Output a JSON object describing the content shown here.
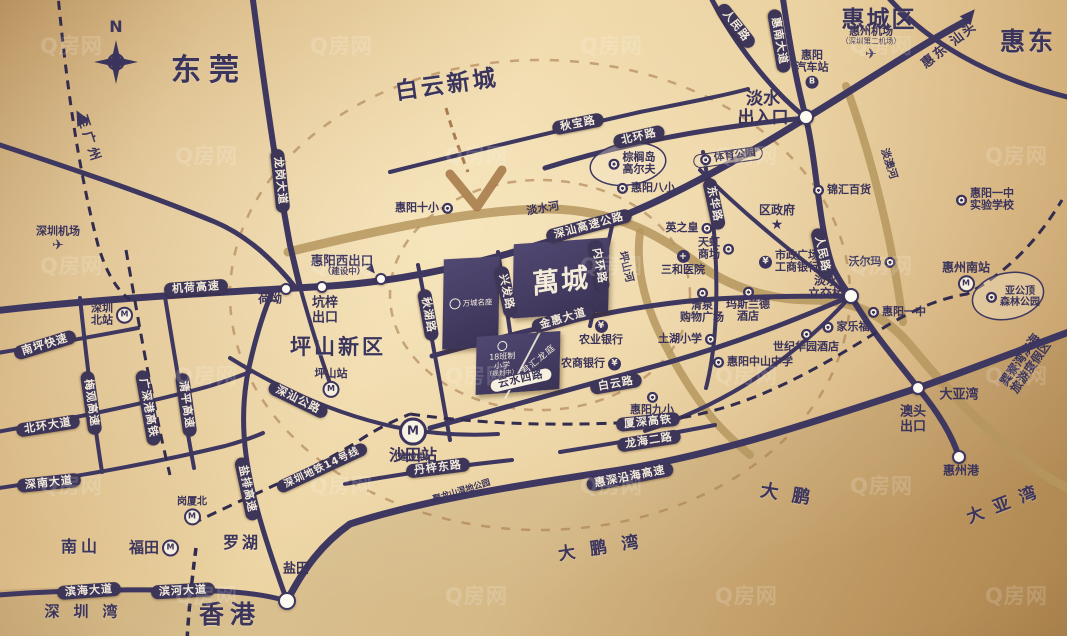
{
  "map": {
    "title": "萬城区位图",
    "watermark": {
      "text": "Q房网"
    },
    "colors": {
      "ink": "#3b345c",
      "road": "#3e3760",
      "river": "#b5965e",
      "gold_bg": "#e7cc99",
      "accent_tan": "#a87c4c"
    },
    "project": {
      "name": "萬城"
    },
    "blocks": {
      "mingzuo": "万城名座",
      "school_line1": "18班制",
      "school_line2": "小学",
      "school_line3": "（规划中）",
      "junhui": "君汇龙庭"
    },
    "junctions": [
      {
        "x": 806,
        "y": 117,
        "r": 6
      },
      {
        "x": 851,
        "y": 296,
        "r": 6
      },
      {
        "x": 287,
        "y": 601,
        "r": 7
      },
      {
        "x": 918,
        "y": 388,
        "r": 5
      },
      {
        "x": 286,
        "y": 289,
        "r": 4
      },
      {
        "x": 322,
        "y": 287,
        "r": 4
      },
      {
        "x": 381,
        "y": 279,
        "r": 4
      },
      {
        "x": 959,
        "y": 457,
        "r": 5
      }
    ],
    "labels": [
      {
        "name": "compass-n-label",
        "kind": "text",
        "text": "N",
        "x": 116,
        "y": 27,
        "size": 16,
        "cls": "bold"
      },
      {
        "name": "label-dongguan",
        "kind": "area",
        "text": "东莞",
        "x": 209,
        "y": 71,
        "size": 30,
        "ls": 8
      },
      {
        "name": "label-baiyun-xincheng",
        "kind": "area",
        "text": "白云新城",
        "x": 447,
        "y": 86,
        "size": 23,
        "rot": -8,
        "ls": 3
      },
      {
        "name": "label-huicheng-district",
        "kind": "area",
        "text": "惠城区",
        "x": 879,
        "y": 21,
        "size": 23,
        "ls": 2
      },
      {
        "name": "label-huidong",
        "kind": "area",
        "text": "惠东",
        "x": 1028,
        "y": 42,
        "size": 25,
        "ls": 3
      },
      {
        "name": "label-huidong-shantou",
        "kind": "text",
        "text": "惠东 汕头",
        "x": 950,
        "y": 46,
        "size": 13,
        "rot": -38,
        "ls": 2
      },
      {
        "name": "label-to-guangzhou",
        "kind": "text",
        "text": "至广州",
        "x": 88,
        "y": 140,
        "size": 13,
        "rot": 72,
        "ls": 4
      },
      {
        "name": "label-pingshan-new-district",
        "kind": "area",
        "text": "坪山新区",
        "x": 338,
        "y": 348,
        "size": 21,
        "ls": 3
      },
      {
        "name": "label-nanshan",
        "kind": "area",
        "text": "南山",
        "x": 81,
        "y": 547,
        "size": 16,
        "ls": 4
      },
      {
        "name": "label-luohu",
        "kind": "area",
        "text": "罗湖",
        "x": 242,
        "y": 543,
        "size": 16,
        "ls": 3
      },
      {
        "name": "label-yantian",
        "kind": "text",
        "text": "盐田",
        "x": 296,
        "y": 570,
        "size": 13
      },
      {
        "name": "label-hongkong",
        "kind": "area",
        "text": "香港",
        "x": 230,
        "y": 615,
        "size": 25,
        "ls": 6
      },
      {
        "name": "label-shenzhen-bay",
        "kind": "area",
        "text": "深圳湾",
        "x": 88,
        "y": 612,
        "size": 15,
        "ls": 14
      },
      {
        "name": "label-dapeng",
        "kind": "area",
        "text": "大鹏",
        "x": 792,
        "y": 496,
        "size": 18,
        "ls": 14,
        "rot": 9
      },
      {
        "name": "label-dapeng-bay",
        "kind": "area",
        "text": "大鹏湾",
        "x": 606,
        "y": 548,
        "size": 17,
        "ls": 15,
        "rot": -9
      },
      {
        "name": "label-daya-bay-big",
        "kind": "area",
        "text": "大亚湾",
        "x": 1007,
        "y": 504,
        "size": 17,
        "ls": 11,
        "rot": -21
      },
      {
        "name": "road-longgang-avenue",
        "kind": "capsule",
        "text": "龙岗大道",
        "x": 280,
        "y": 181,
        "rot": 84
      },
      {
        "name": "road-jihe-expressway",
        "kind": "capsule",
        "text": "机荷高速",
        "x": 196,
        "y": 288,
        "rot": -4
      },
      {
        "name": "road-qiubao-road",
        "kind": "capsule",
        "text": "秋宝路",
        "x": 578,
        "y": 124,
        "rot": -11
      },
      {
        "name": "road-beihuan-road",
        "kind": "capsule",
        "text": "北环路",
        "x": 639,
        "y": 137,
        "rot": -13
      },
      {
        "name": "road-huinan-avenue",
        "kind": "capsule",
        "text": "惠南大道",
        "x": 779,
        "y": 41,
        "rot": 80
      },
      {
        "name": "road-renmin-road-north",
        "kind": "capsule",
        "text": "人民路",
        "x": 736,
        "y": 26,
        "rot": 52
      },
      {
        "name": "road-renmin-road",
        "kind": "capsule",
        "text": "人民路",
        "x": 822,
        "y": 254,
        "rot": 78
      },
      {
        "name": "road-donghua-road",
        "kind": "capsule",
        "text": "东华路",
        "x": 714,
        "y": 204,
        "rot": 78
      },
      {
        "name": "road-shenshan-expressway",
        "kind": "capsule",
        "text": "深汕高速公路",
        "x": 589,
        "y": 226,
        "rot": -15
      },
      {
        "name": "road-neihuan-road",
        "kind": "capsule",
        "text": "内环路",
        "x": 599,
        "y": 266,
        "rot": 80
      },
      {
        "name": "road-xingfa-road",
        "kind": "capsule",
        "text": "兴发路",
        "x": 506,
        "y": 292,
        "rot": 78
      },
      {
        "name": "road-qiuhu-road",
        "kind": "capsule",
        "text": "秋湖路",
        "x": 428,
        "y": 315,
        "rot": 80
      },
      {
        "name": "road-jinhui-avenue",
        "kind": "capsule",
        "text": "金惠大道",
        "x": 563,
        "y": 319,
        "rot": -16
      },
      {
        "name": "road-baiyun-road",
        "kind": "capsule",
        "text": "白云路",
        "x": 616,
        "y": 384,
        "rot": -10
      },
      {
        "name": "road-shenshan-highway",
        "kind": "capsule",
        "text": "深汕公路",
        "x": 298,
        "y": 400,
        "rot": 26
      },
      {
        "name": "road-nanping-expressway",
        "kind": "capsule",
        "text": "南坪快速",
        "x": 45,
        "y": 345,
        "rot": -17
      },
      {
        "name": "road-meiguan-expressway",
        "kind": "capsule",
        "text": "梅观高速",
        "x": 91,
        "y": 403,
        "rot": 82
      },
      {
        "name": "rail-guangshengang-hsr",
        "kind": "capsule",
        "text": "广深港高铁",
        "x": 148,
        "y": 408,
        "rot": 80
      },
      {
        "name": "road-qingping-expressway",
        "kind": "capsule",
        "text": "清平高速",
        "x": 186,
        "y": 405,
        "rot": 82
      },
      {
        "name": "road-beihuan-avenue",
        "kind": "capsule",
        "text": "北环大道",
        "x": 48,
        "y": 426,
        "rot": -9
      },
      {
        "name": "road-shennan-avenue",
        "kind": "capsule",
        "text": "深南大道",
        "x": 49,
        "y": 483,
        "rot": -6
      },
      {
        "name": "road-yanpai-expressway",
        "kind": "capsule",
        "text": "盐排高速",
        "x": 247,
        "y": 489,
        "rot": 78
      },
      {
        "name": "rail-shenzhen-metro-line14",
        "kind": "capsule",
        "text": "深圳地铁14号线",
        "x": 322,
        "y": 468,
        "rot": -25,
        "size": 10
      },
      {
        "name": "road-binhai-avenue",
        "kind": "capsule",
        "text": "滨海大道",
        "x": 89,
        "y": 591,
        "rot": -4
      },
      {
        "name": "road-binhe-avenue",
        "kind": "capsule",
        "text": "滨河大道",
        "x": 183,
        "y": 591,
        "rot": -3
      },
      {
        "name": "road-danzi-east-road",
        "kind": "capsule",
        "text": "丹梓东路",
        "x": 438,
        "y": 468,
        "rot": -7
      },
      {
        "name": "rail-xiashen-hsr",
        "kind": "capsule",
        "text": "厦深高铁",
        "x": 648,
        "y": 422,
        "rot": -6
      },
      {
        "name": "road-longhai-2nd-road",
        "kind": "capsule",
        "text": "龙海二路",
        "x": 649,
        "y": 441,
        "rot": -9
      },
      {
        "name": "road-huishen-coastal-expressway",
        "kind": "capsule",
        "text": "惠深沿海高速",
        "x": 630,
        "y": 477,
        "rot": -11
      },
      {
        "name": "road-yunshui-4th-road",
        "kind": "white-capsule",
        "text": "云水四路",
        "x": 521,
        "y": 380,
        "rot": -13
      },
      {
        "name": "poi-sports-park",
        "kind": "capsule-outline",
        "text": "体育公园",
        "x": 728,
        "y": 157,
        "rot": -8,
        "icon": "dot",
        "iconSide": "left"
      },
      {
        "name": "poi-shenzhen-airport",
        "kind": "poi",
        "text": "深圳机场",
        "x": 58,
        "y": 240,
        "icon": "air",
        "iconSide": "bottom"
      },
      {
        "name": "poi-shenzhen-north-station",
        "kind": "poi",
        "lines": [
          "深圳",
          "北站"
        ],
        "x": 112,
        "y": 315,
        "icon": "metro",
        "iconSide": "right"
      },
      {
        "name": "poi-pingshan-station",
        "kind": "poi",
        "text": "坪山站",
        "x": 331,
        "y": 383,
        "icon": "metro",
        "iconSide": "bottom"
      },
      {
        "name": "poi-shatian-station",
        "kind": "poi",
        "text": "沙田站",
        "x": 413,
        "y": 441,
        "size": 16,
        "icon": "metro-big",
        "iconSide": "top"
      },
      {
        "name": "label-shatian-under-construction",
        "kind": "text",
        "text": "（建设中）",
        "x": 412,
        "y": 458,
        "size": 9
      },
      {
        "name": "poi-gangxiabei-station",
        "kind": "poi",
        "text": "岗厦北",
        "x": 192,
        "y": 511,
        "size": 10,
        "icon": "metro",
        "iconSide": "bottom"
      },
      {
        "name": "poi-futian",
        "kind": "poi",
        "text": "福田",
        "x": 154,
        "y": 548,
        "size": 15,
        "icon": "metro",
        "iconSide": "right"
      },
      {
        "name": "poi-huiyang-no10-primary",
        "kind": "poi",
        "text": "惠阳十小",
        "x": 424,
        "y": 208,
        "icon": "dot",
        "iconSide": "right"
      },
      {
        "name": "poi-huiyang-no8-primary",
        "kind": "poi",
        "text": "惠阳八小",
        "x": 646,
        "y": 188,
        "icon": "dot",
        "iconSide": "left"
      },
      {
        "name": "poi-palm-island-golf",
        "kind": "poi",
        "lines": [
          "棕榈岛",
          "高尔夫"
        ],
        "x": 632,
        "y": 164,
        "icon": "dot",
        "iconSide": "left"
      },
      {
        "name": "poi-huiyang-bus-station",
        "kind": "poi",
        "lines": [
          "惠阳",
          "汽车站"
        ],
        "x": 812,
        "y": 69,
        "icon": "bus",
        "iconSide": "bottom"
      },
      {
        "name": "poi-huizhou-airport",
        "kind": "poi",
        "lines": [
          "惠州机场",
          "（深圳第二机场）"
        ],
        "subLast": true,
        "x": 871,
        "y": 44,
        "icon": "air",
        "iconSide": "bottom"
      },
      {
        "name": "poi-jinhui-department-store",
        "kind": "poi",
        "text": "锦汇百货",
        "x": 842,
        "y": 190,
        "icon": "cart",
        "iconSide": "left"
      },
      {
        "name": "poi-district-government",
        "kind": "poi",
        "text": "区政府",
        "x": 777,
        "y": 219,
        "size": 12,
        "icon": "star",
        "iconSide": "bottom"
      },
      {
        "name": "poi-yingzhihuang",
        "kind": "poi",
        "text": "英之皇",
        "x": 689,
        "y": 228,
        "icon": "dot",
        "iconSide": "right"
      },
      {
        "name": "poi-tianhong-mall",
        "kind": "poi",
        "lines": [
          "天虹",
          "商场"
        ],
        "x": 716,
        "y": 249,
        "icon": "dot",
        "iconSide": "right"
      },
      {
        "name": "poi-sanhe-hospital",
        "kind": "poi",
        "text": "三和医院",
        "x": 683,
        "y": 263,
        "icon": "hosp",
        "iconSide": "top"
      },
      {
        "name": "poi-municipal-plaza-icbc",
        "kind": "poi",
        "lines": [
          "市政广场",
          "工商银行"
        ],
        "x": 789,
        "y": 262,
        "icon": "bank",
        "iconSide": "left"
      },
      {
        "name": "poi-walmart",
        "kind": "poi",
        "text": "沃尔玛",
        "x": 872,
        "y": 262,
        "icon": "cart",
        "iconSide": "right"
      },
      {
        "name": "label-danshui-interchange",
        "kind": "text",
        "lines": [
          "淡水",
          "立交桥"
        ],
        "x": 826,
        "y": 288,
        "size": 12
      },
      {
        "name": "poi-huizhou-south-station",
        "kind": "poi",
        "text": "惠州南站",
        "x": 966,
        "y": 277,
        "size": 12,
        "icon": "metro",
        "iconSide": "bottom"
      },
      {
        "name": "poi-yagongding-forest-park",
        "kind": "poi",
        "lines": [
          "亚公顶",
          "森林公园"
        ],
        "x": 1013,
        "y": 297,
        "size": 10,
        "icon": "dot",
        "iconSide": "left"
      },
      {
        "name": "poi-huiyang-no1-experimental-school",
        "kind": "poi",
        "lines": [
          "惠阳一中",
          "实验学校"
        ],
        "x": 985,
        "y": 200,
        "icon": "dot",
        "iconSide": "left"
      },
      {
        "name": "poi-qingquan-shopping-plaza",
        "kind": "poi",
        "lines": [
          "清泉",
          "购物广场"
        ],
        "x": 702,
        "y": 306,
        "icon": "dot",
        "iconSide": "top"
      },
      {
        "name": "poi-maslande-hotel",
        "kind": "poi",
        "lines": [
          "玛斯兰德",
          "酒店"
        ],
        "x": 748,
        "y": 305,
        "icon": "dot",
        "iconSide": "top"
      },
      {
        "name": "poi-tuhu-primary-school",
        "kind": "poi",
        "text": "土湖小学",
        "x": 687,
        "y": 339,
        "icon": "dot",
        "iconSide": "right"
      },
      {
        "name": "poi-agricultural-bank",
        "kind": "poi",
        "text": "农业银行",
        "x": 601,
        "y": 333,
        "icon": "bank",
        "iconSide": "top"
      },
      {
        "name": "poi-rural-commercial-bank",
        "kind": "poi",
        "text": "农商银行",
        "x": 591,
        "y": 364,
        "icon": "bank",
        "iconSide": "right"
      },
      {
        "name": "poi-century-huayuan-hotel",
        "kind": "poi",
        "text": "世纪华园酒店",
        "x": 806,
        "y": 341,
        "icon": "dot",
        "iconSide": "top"
      },
      {
        "name": "poi-carrefour",
        "kind": "poi",
        "text": "家乐福",
        "x": 846,
        "y": 327,
        "icon": "cart",
        "iconSide": "left"
      },
      {
        "name": "poi-huiyang-no1-middle-school",
        "kind": "poi",
        "text": "惠阳一中",
        "x": 897,
        "y": 312,
        "icon": "dot",
        "iconSide": "left"
      },
      {
        "name": "poi-huiyang-zhongshan-middle-school",
        "kind": "poi",
        "text": "惠阳中山中学",
        "x": 753,
        "y": 362,
        "icon": "dot",
        "iconSide": "left"
      },
      {
        "name": "poi-huiyang-no9-primary",
        "kind": "poi",
        "text": "惠阳九小",
        "x": 652,
        "y": 404,
        "icon": "dot",
        "iconSide": "top"
      },
      {
        "name": "label-heao",
        "kind": "text",
        "text": "荷坳",
        "x": 270,
        "y": 299,
        "size": 12
      },
      {
        "name": "label-kengzi-exit",
        "kind": "text",
        "lines": [
          "坑梓",
          "出口"
        ],
        "x": 325,
        "y": 311,
        "size": 13
      },
      {
        "name": "label-huiyang-west-exit",
        "kind": "text",
        "text": "惠阳西出口",
        "x": 342,
        "y": 261,
        "size": 12.5
      },
      {
        "name": "label-huiyang-west-under-construction",
        "kind": "text",
        "text": "（建设中）",
        "x": 344,
        "y": 273,
        "size": 8.5
      },
      {
        "name": "label-danshui-entrance",
        "kind": "text",
        "lines": [
          "淡水",
          "出入口"
        ],
        "x": 763,
        "y": 109,
        "size": 17
      },
      {
        "name": "label-aotou-exit",
        "kind": "text",
        "lines": [
          "澳头",
          "出口"
        ],
        "x": 913,
        "y": 420,
        "size": 13
      },
      {
        "name": "label-daya-bay-junction",
        "kind": "text",
        "text": "大亚湾",
        "x": 959,
        "y": 396,
        "size": 13
      },
      {
        "name": "label-huizhou-port",
        "kind": "text",
        "text": "惠州港",
        "x": 961,
        "y": 471,
        "size": 12
      },
      {
        "name": "label-danshui-river",
        "kind": "text",
        "text": "淡水河",
        "x": 543,
        "y": 209,
        "size": 11,
        "rot": -10
      },
      {
        "name": "label-pingshan-river",
        "kind": "text",
        "text": "坪山河",
        "x": 625,
        "y": 267,
        "size": 10.5,
        "rot": 76
      },
      {
        "name": "label-danao-river",
        "kind": "text",
        "text": "淡澳河",
        "x": 888,
        "y": 164,
        "size": 10.5,
        "rot": 72
      },
      {
        "name": "label-julongshan-wetland-park",
        "kind": "text",
        "text": "聚龙山湿地公园",
        "x": 462,
        "y": 492,
        "size": 8.5,
        "rot": -17
      },
      {
        "name": "label-xunliao-bay-resort",
        "kind": "text",
        "lines": [
          "巽寮湾滨海",
          "旅游度假区"
        ],
        "x": 1026,
        "y": 364,
        "size": 12,
        "rot": -55
      },
      {
        "name": "arrow-huidong-shantou-icon",
        "kind": "arrow",
        "x": 970,
        "y": 15,
        "rot": 40
      },
      {
        "name": "arrow-to-guangzhou-icon",
        "kind": "arrow",
        "x": 80,
        "y": 117,
        "rot": -28
      },
      {
        "name": "arrow-huiyang-west-exit-icon",
        "kind": "arrow",
        "x": 372,
        "y": 270,
        "rot": 140,
        "cls": "small"
      }
    ]
  }
}
